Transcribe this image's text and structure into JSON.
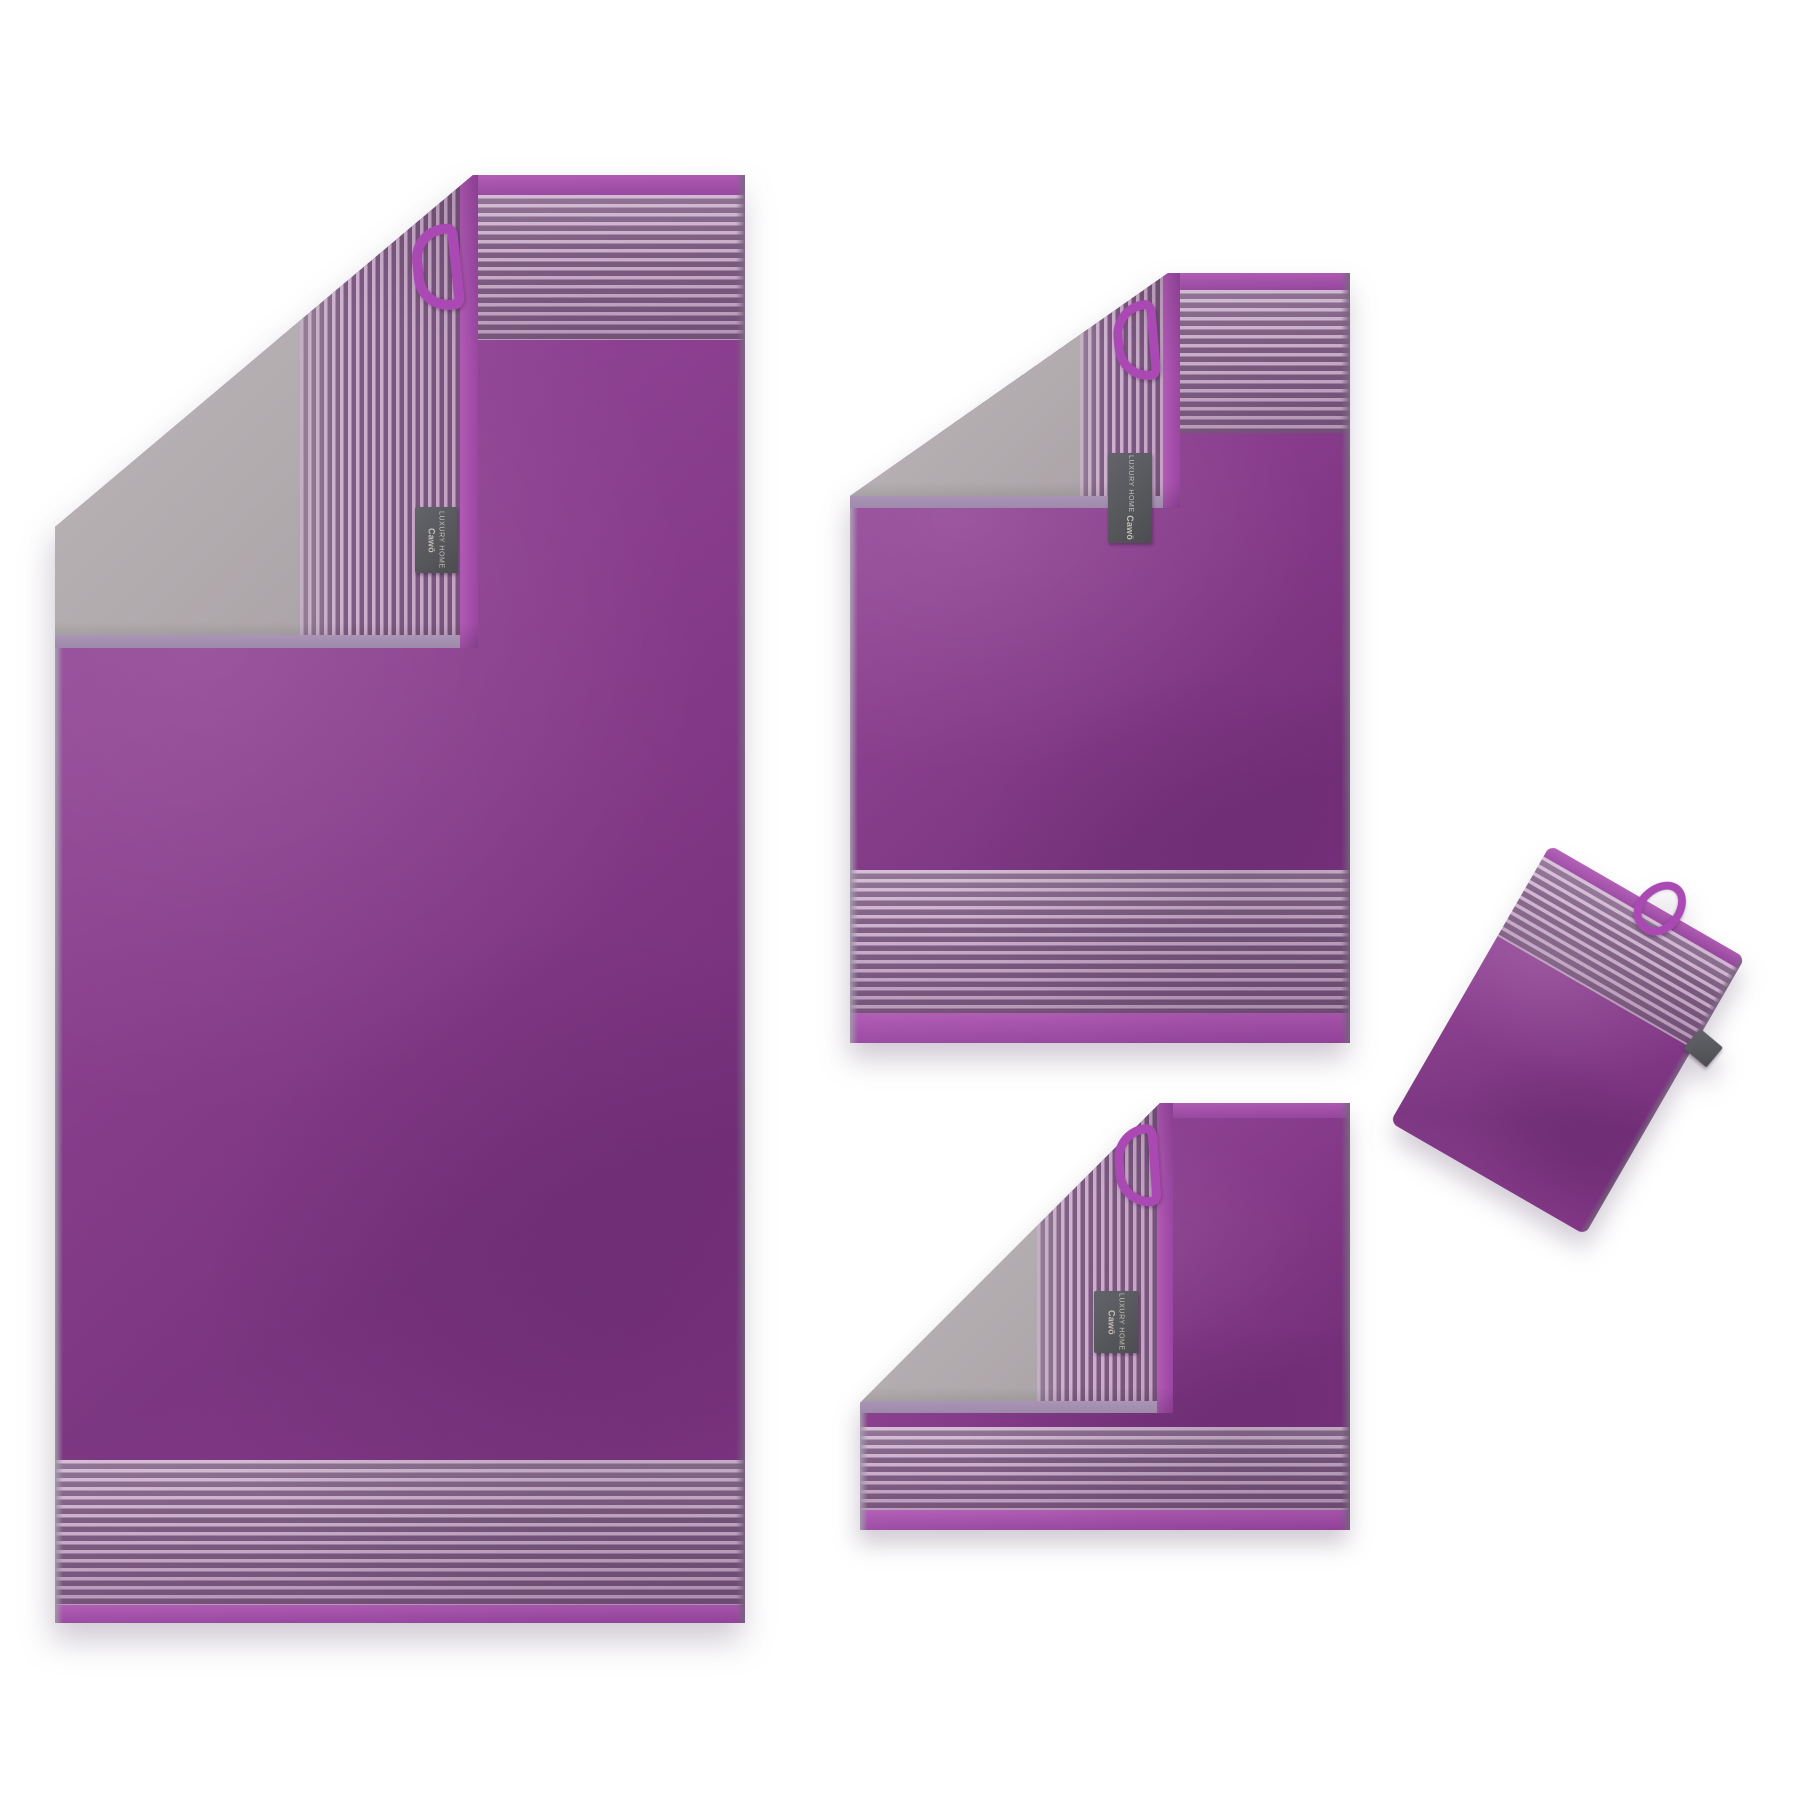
{
  "page": {
    "background": "#ffffff",
    "type": "product-photo"
  },
  "scene": {
    "description": "Four-piece plum violet and silver-grey two-tone terry towel set on a white background: large bath towel, hand towel, guest towel and wash mitt. Each piece has a corner folded back revealing the grey reverse side, pinstriped border bands, a violet hanging loop and a dark woven brand tag."
  },
  "brand_tag": {
    "line1": "LUXURY HOME",
    "brand": "Cawö"
  },
  "colors": {
    "purple": "#8a3a8e",
    "purpleLight": "#96459c",
    "purpleDark": "#7a3180",
    "hem1": "#b25ab6",
    "hem2": "#9a46a2",
    "stripeL": "#cfb2d0",
    "stripeD": "#7d5a82",
    "gray1": "#c0bbbd",
    "gray2": "#a79fa3",
    "lav": "#b7a0c5",
    "edgeR": "#7e6886",
    "edgeL": "#a095aa",
    "loop": "#ab49b4",
    "tagBg": "#56575b",
    "tagText": "#c6c0b8"
  },
  "items": [
    {
      "id": "bath-towel",
      "label": "Bath towel"
    },
    {
      "id": "hand-towel",
      "label": "Hand towel"
    },
    {
      "id": "guest-towel",
      "label": "Guest towel"
    },
    {
      "id": "wash-mitt",
      "label": "Wash mitt"
    }
  ]
}
